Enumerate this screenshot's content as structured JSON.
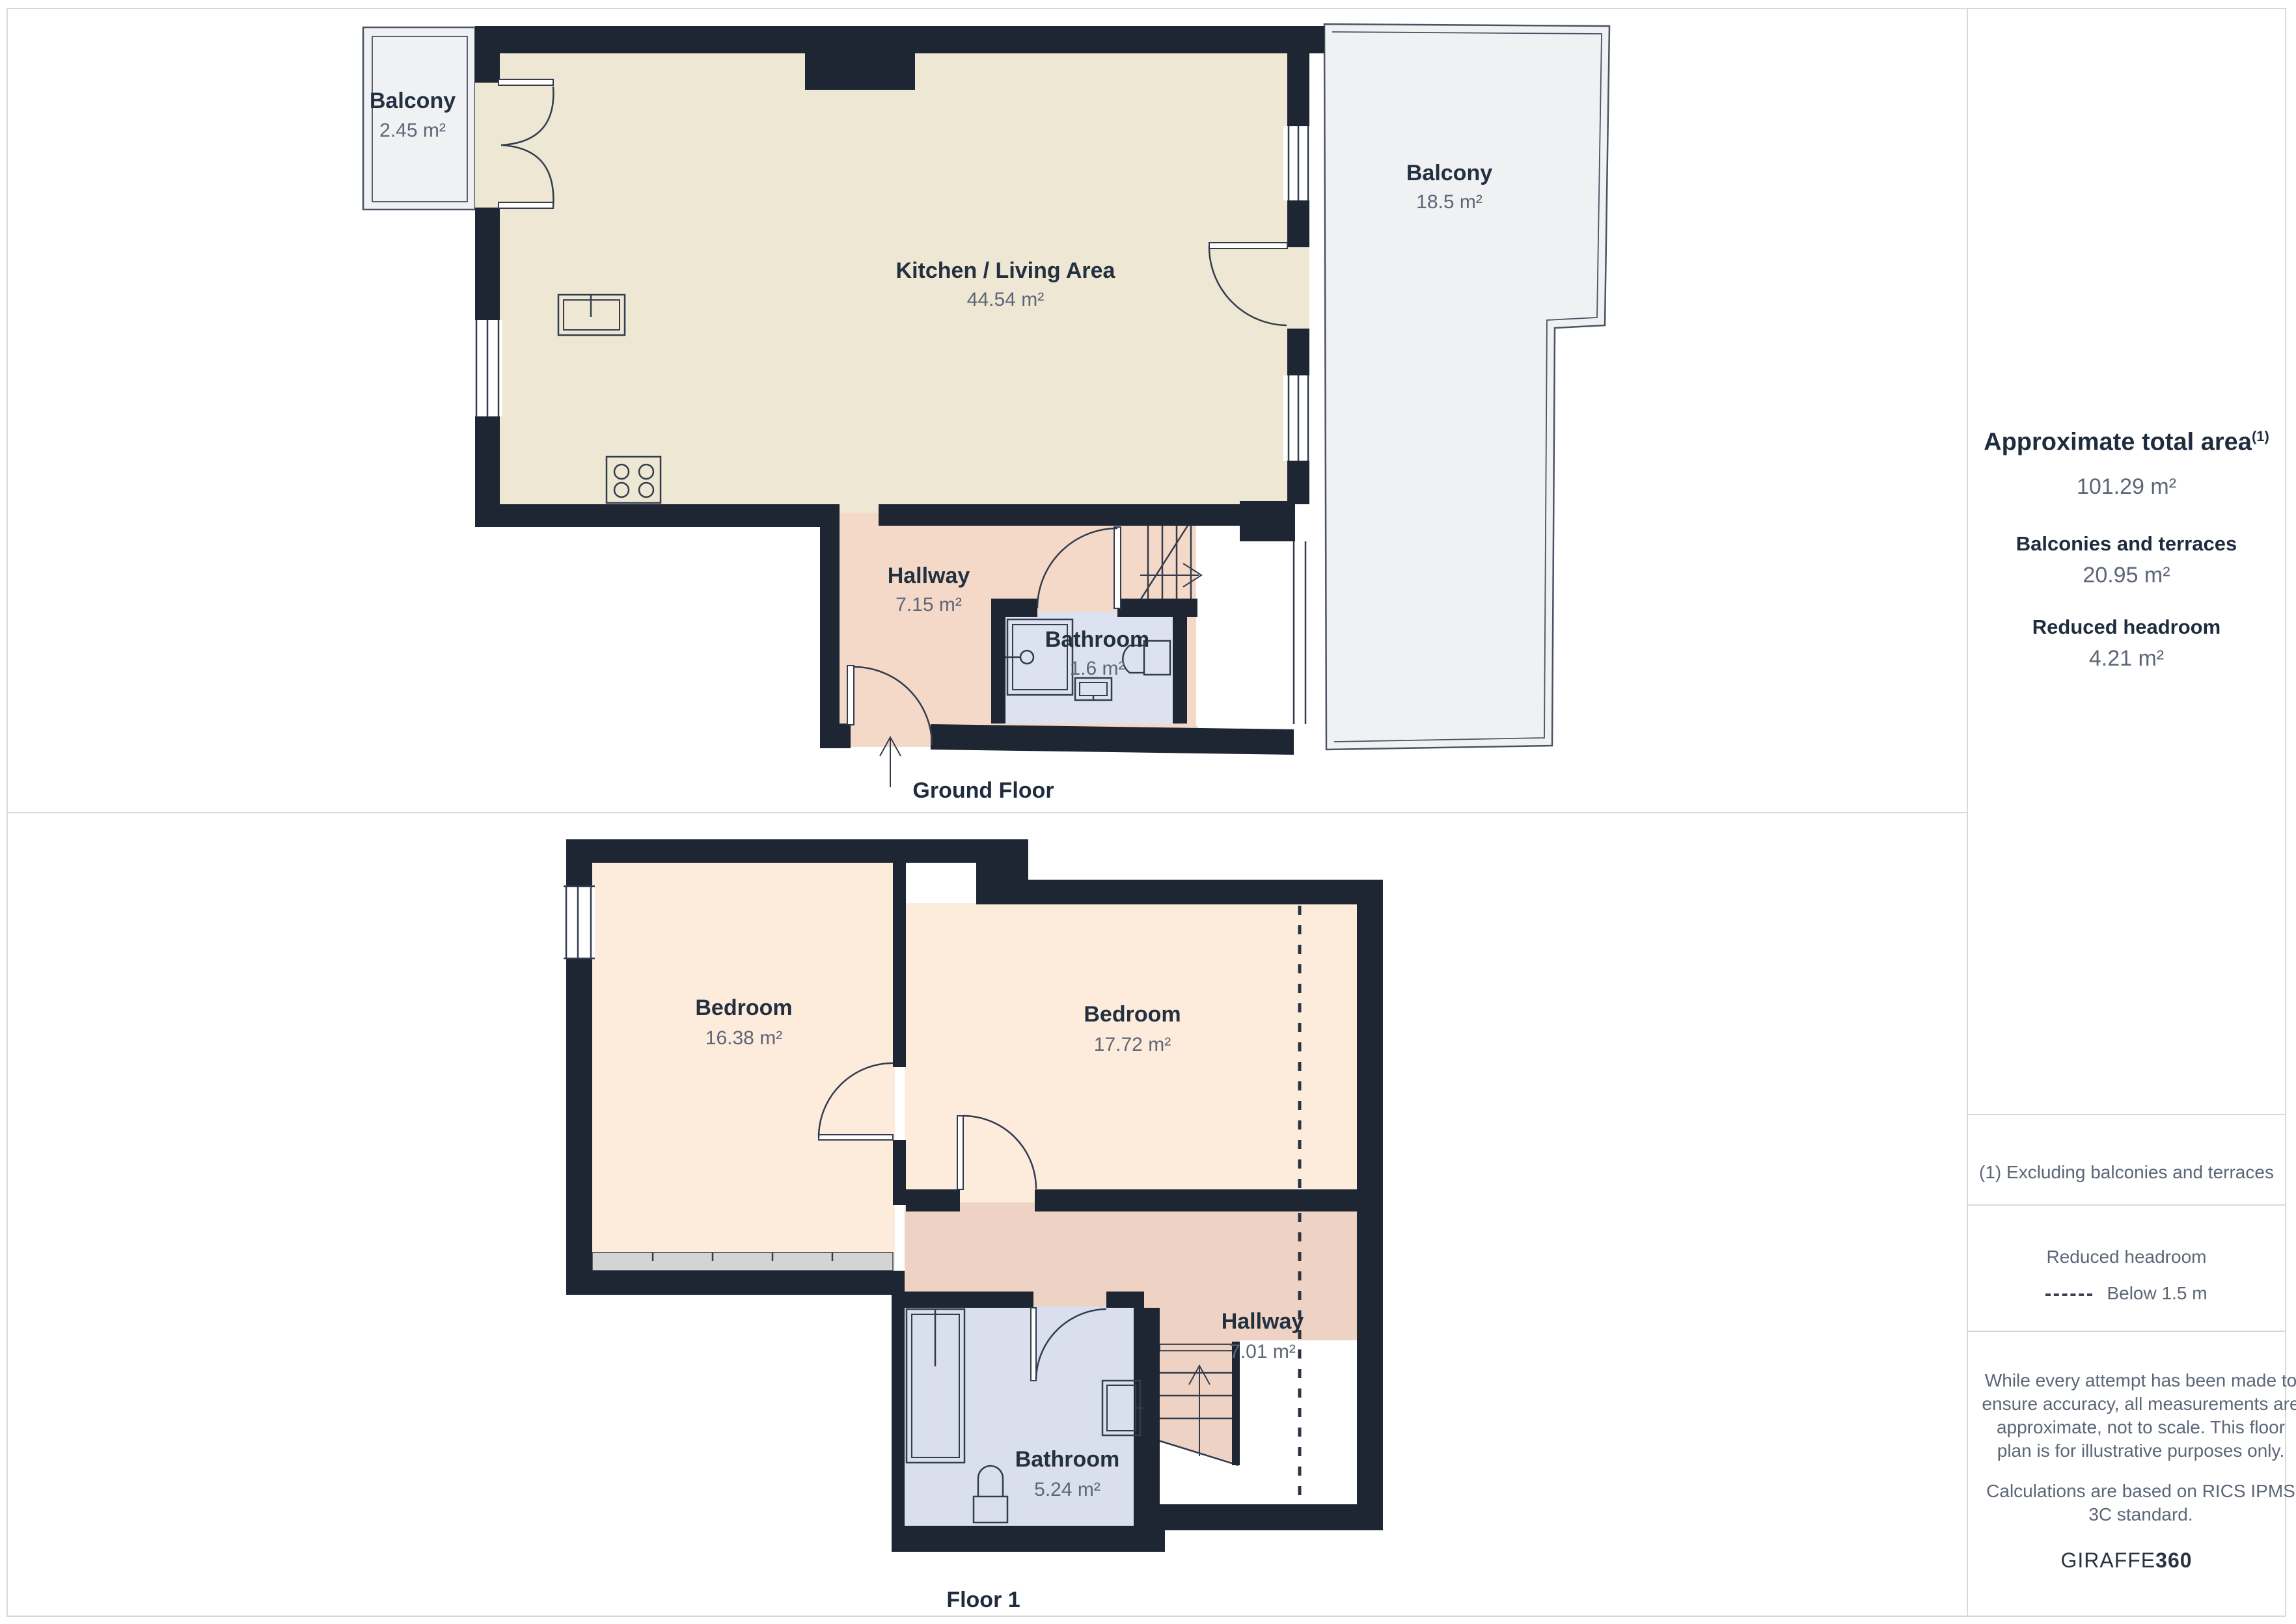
{
  "floors": [
    {
      "label": "Ground Floor",
      "rooms": [
        {
          "name": "Balcony",
          "area": "2.45 m²"
        },
        {
          "name": "Kitchen / Living Area",
          "area": "44.54 m²"
        },
        {
          "name": "Balcony",
          "area": "18.5 m²"
        },
        {
          "name": "Hallway",
          "area": "7.15 m²"
        },
        {
          "name": "Bathroom",
          "area": "1.6 m²"
        }
      ]
    },
    {
      "label": "Floor 1",
      "rooms": [
        {
          "name": "Bedroom",
          "area": "16.38 m²"
        },
        {
          "name": "Bedroom",
          "area": "17.72 m²"
        },
        {
          "name": "Hallway",
          "area": "7.01 m²"
        },
        {
          "name": "Bathroom",
          "area": "5.24 m²"
        }
      ]
    }
  ],
  "sidebar": {
    "total_area_label": "Approximate total area",
    "total_area_footnote_mark": "(1)",
    "total_area_value": "101.29 m²",
    "balconies_label": "Balconies and terraces",
    "balconies_value": "20.95 m²",
    "reduced_label": "Reduced headroom",
    "reduced_value": "4.21 m²",
    "footnote": "(1) Excluding balconies and terraces",
    "legend_title": "Reduced headroom",
    "legend_item": "Below 1.5 m",
    "disclaimer1": "While every attempt has been made to ensure accuracy, all measurements are approximate, not to scale. This floor plan is for illustrative purposes only.",
    "disclaimer2": "Calculations are based on RICS IPMS 3C standard.",
    "brand_regular": "GIRAFFE",
    "brand_bold": "360"
  },
  "colors": {
    "wall": "#1e2633",
    "kitchen_floor": "#eee7d3",
    "hallway_gf": "#f4d9c8",
    "bathroom_gf": "#dce2ef",
    "bedroom": "#fdebdc",
    "hallway_f1": "#eed3c4",
    "bathroom_f1": "#d9dfed",
    "balcony": "#f0f1f2",
    "label_navy": "#223040",
    "value_gray": "#5c6677"
  }
}
